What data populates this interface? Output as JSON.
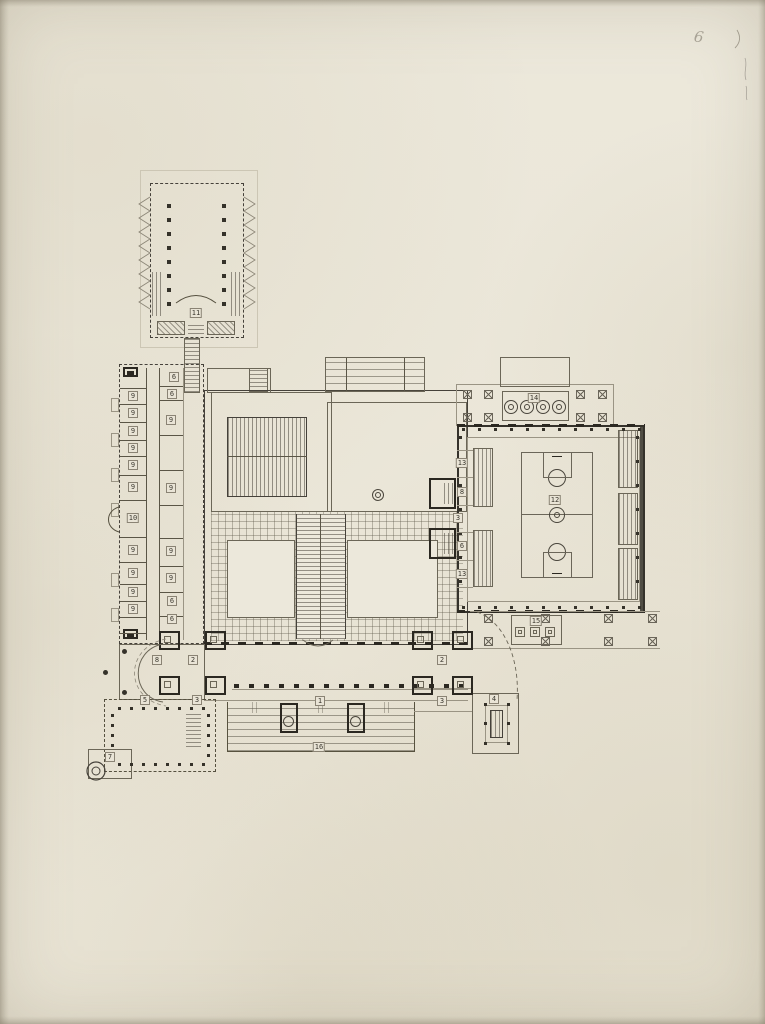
{
  "document": {
    "pencil_mark": "6"
  },
  "plan": {
    "room_labels": [
      {
        "n": "11",
        "x": 196,
        "y": 313
      },
      {
        "n": "6",
        "x": 174,
        "y": 377
      },
      {
        "n": "6",
        "x": 172,
        "y": 394
      },
      {
        "n": "9",
        "x": 133,
        "y": 396
      },
      {
        "n": "9",
        "x": 133,
        "y": 413
      },
      {
        "n": "9",
        "x": 133,
        "y": 431
      },
      {
        "n": "9",
        "x": 133,
        "y": 448
      },
      {
        "n": "9",
        "x": 133,
        "y": 465
      },
      {
        "n": "9",
        "x": 133,
        "y": 487
      },
      {
        "n": "9",
        "x": 171,
        "y": 420
      },
      {
        "n": "9",
        "x": 171,
        "y": 488
      },
      {
        "n": "10",
        "x": 133,
        "y": 518
      },
      {
        "n": "9",
        "x": 133,
        "y": 550
      },
      {
        "n": "9",
        "x": 133,
        "y": 573
      },
      {
        "n": "9",
        "x": 133,
        "y": 592
      },
      {
        "n": "9",
        "x": 133,
        "y": 609
      },
      {
        "n": "9",
        "x": 171,
        "y": 551
      },
      {
        "n": "9",
        "x": 171,
        "y": 578
      },
      {
        "n": "6",
        "x": 172,
        "y": 601
      },
      {
        "n": "6",
        "x": 172,
        "y": 619
      },
      {
        "n": "8",
        "x": 157,
        "y": 660
      },
      {
        "n": "2",
        "x": 193,
        "y": 660
      },
      {
        "n": "5",
        "x": 145,
        "y": 700
      },
      {
        "n": "3",
        "x": 197,
        "y": 700
      },
      {
        "n": "7",
        "x": 110,
        "y": 757
      },
      {
        "n": "1",
        "x": 320,
        "y": 701
      },
      {
        "n": "16",
        "x": 319,
        "y": 747
      },
      {
        "n": "2",
        "x": 442,
        "y": 660
      },
      {
        "n": "3",
        "x": 442,
        "y": 701
      },
      {
        "n": "4",
        "x": 494,
        "y": 699
      },
      {
        "n": "13",
        "x": 462,
        "y": 463
      },
      {
        "n": "8",
        "x": 462,
        "y": 492
      },
      {
        "n": "3",
        "x": 458,
        "y": 518
      },
      {
        "n": "6",
        "x": 462,
        "y": 546
      },
      {
        "n": "13",
        "x": 462,
        "y": 574
      },
      {
        "n": "12",
        "x": 555,
        "y": 500
      },
      {
        "n": "14",
        "x": 534,
        "y": 398
      },
      {
        "n": "15",
        "x": 536,
        "y": 621
      }
    ]
  },
  "colors": {
    "paper": "#ece8db",
    "ink": "#4a4538",
    "ink_heavy": "#2b2821",
    "ink_light": "#8d8778"
  }
}
